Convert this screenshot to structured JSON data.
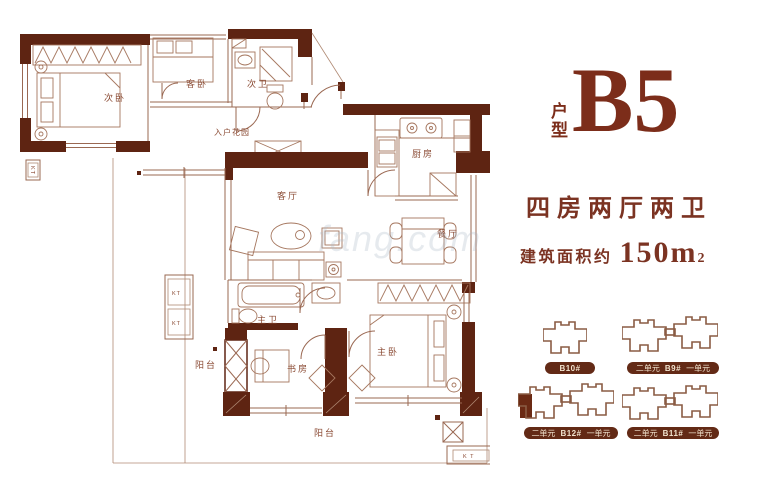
{
  "title": {
    "prefix": "户型",
    "name": "B5"
  },
  "specs": {
    "layout": "四房两厅两卫",
    "area_label": "建筑面积约",
    "area_value": "150m",
    "area_exp": "2"
  },
  "plan": {
    "rooms": {
      "ciwo": "次卧",
      "kewo": "客卧",
      "ciwei": "次卫",
      "ruhua": "入户花园",
      "chufang": "厨房",
      "keting": "客厅",
      "canting": "餐厅",
      "zhuwei": "主卫",
      "shufang": "书房",
      "zhuwo": "主卧",
      "yangtai_left": "阳台",
      "yangtai_bottom": "阳台"
    },
    "ac": {
      "kt": "KT",
      "kt_spaced": "K T"
    }
  },
  "buildings": [
    {
      "name": "B10#",
      "left": "",
      "right": ""
    },
    {
      "name": "B9#",
      "left": "二单元",
      "right": "一单元"
    },
    {
      "name": "B12#",
      "left": "二单元",
      "right": "一单元"
    },
    {
      "name": "B11#",
      "left": "二单元",
      "right": "一单元"
    }
  ],
  "watermark": "fang.com",
  "colors": {
    "wall": "#5e2412",
    "line": "#9a6852",
    "room_label": "#8a4a33",
    "accent": "#7c2d1a",
    "pill_bg": "#632a16",
    "pill_text": "#f2e4cf"
  }
}
